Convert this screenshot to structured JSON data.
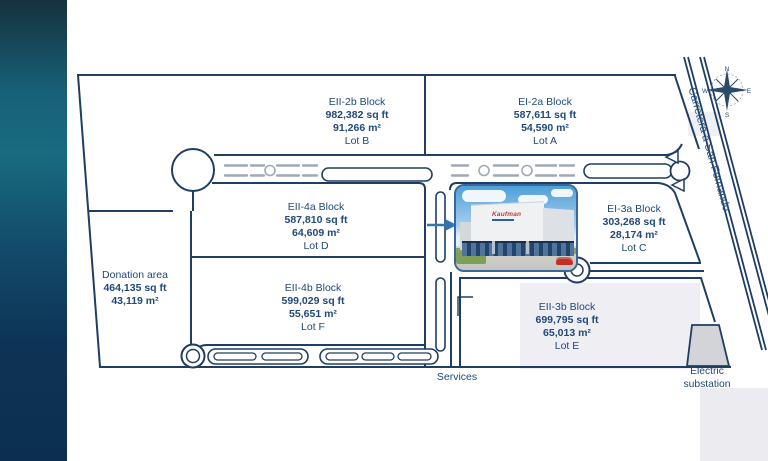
{
  "plan": {
    "blocks": [
      {
        "name": "EII-2b Block",
        "sqft": "982,382 sq ft",
        "sqm": "91,266 m²",
        "lot": "Lot B"
      },
      {
        "name": "EI-2a Block",
        "sqft": "587,611 sq ft",
        "sqm": "54,590 m²",
        "lot": "Lot A"
      },
      {
        "name": "EII-4a Block",
        "sqft": "587,810 sq ft",
        "sqm": "64,609 m²",
        "lot": "Lot D"
      },
      {
        "name": "EI-3a Block",
        "sqft": "303,268 sq ft",
        "sqm": "28,174 m²",
        "lot": "Lot C"
      },
      {
        "name": "EII-4b Block",
        "sqft": "599,029 sq ft",
        "sqm": "55,651 m²",
        "lot": "Lot F"
      },
      {
        "name": "EII-3b Block",
        "sqft": "699,795 sq ft",
        "sqm": "65,013 m²",
        "lot": "Lot E"
      },
      {
        "name": "Donation area",
        "sqft": "464,135 sq ft",
        "sqm": "43,119 m²",
        "lot": ""
      }
    ],
    "roads": {
      "highway_label": "Carretera a San Fernando",
      "services_label": "Services"
    },
    "facilities": {
      "electric_substation": "Electric substation"
    },
    "compass": {
      "north": "N",
      "east": "E",
      "south": "S",
      "west": "W"
    },
    "photo": {
      "logo_text": "Kaufman"
    },
    "colors": {
      "line_navy": "#1f3e63",
      "text_navy": "#21497a",
      "band_teal": "#196b7f",
      "band_navy": "#0d3355",
      "substation_gray": "#d3d4d8",
      "road_dash_gray": "#9fa9b6",
      "arrow_blue": "#2e75b6"
    }
  }
}
